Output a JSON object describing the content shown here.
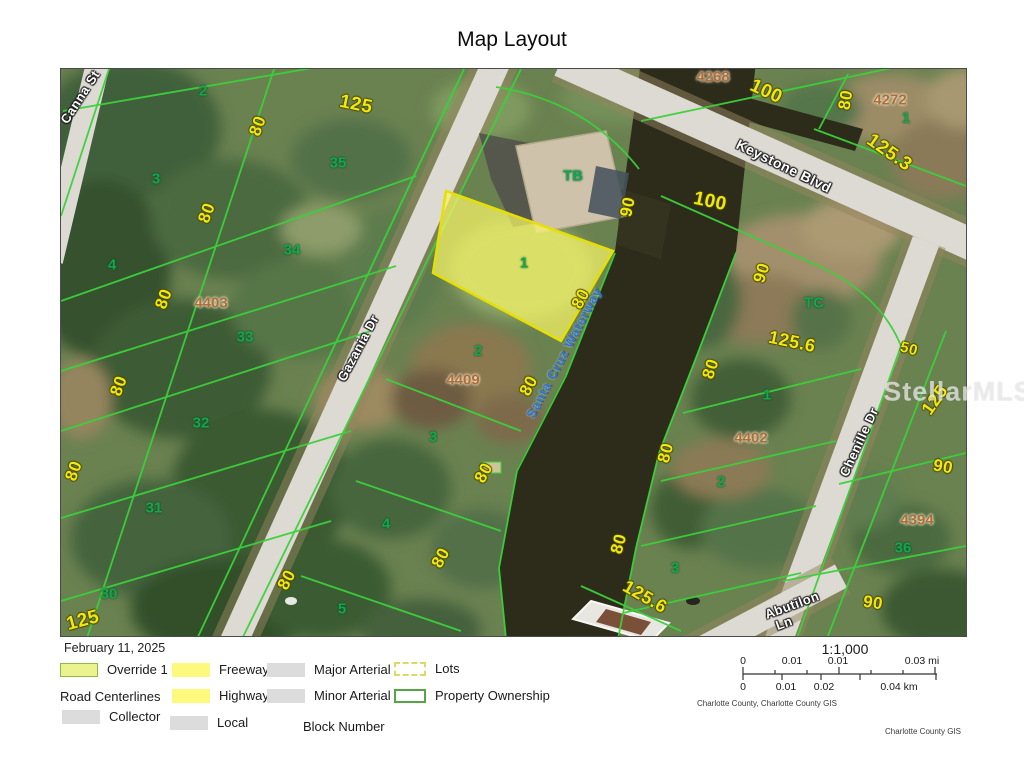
{
  "title": "Map Layout",
  "date": "February 11, 2025",
  "watermark": "StellarMLS",
  "map": {
    "street_labels": [
      {
        "text": "Canna St",
        "x": 19,
        "y": 28,
        "r": -57
      },
      {
        "text": "Gazania Dr",
        "x": 297,
        "y": 279,
        "r": -62
      },
      {
        "text": "Keystone Blvd",
        "x": 723,
        "y": 97,
        "r": 26,
        "fs": 14
      },
      {
        "text": "Chenille Dr",
        "x": 798,
        "y": 373,
        "r": -65
      },
      {
        "text": "Abutilon",
        "x": 731,
        "y": 536,
        "r": -20
      },
      {
        "text": "Ln",
        "x": 723,
        "y": 554,
        "r": -20
      }
    ],
    "water_labels": [
      {
        "text": "Santa Cruz Waterway",
        "x": 503,
        "y": 284,
        "r": -62
      }
    ],
    "lot_numbers": [
      {
        "text": "2",
        "x": 142,
        "y": 22
      },
      {
        "text": "3",
        "x": 95,
        "y": 110
      },
      {
        "text": "4",
        "x": 51,
        "y": 196
      },
      {
        "text": "35",
        "x": 277,
        "y": 94
      },
      {
        "text": "34",
        "x": 231,
        "y": 181
      },
      {
        "text": "33",
        "x": 184,
        "y": 268
      },
      {
        "text": "32",
        "x": 140,
        "y": 354
      },
      {
        "text": "31",
        "x": 93,
        "y": 439
      },
      {
        "text": "30",
        "x": 48,
        "y": 525
      },
      {
        "text": "TB",
        "x": 512,
        "y": 107
      },
      {
        "text": "1",
        "x": 463,
        "y": 194
      },
      {
        "text": "2",
        "x": 417,
        "y": 282
      },
      {
        "text": "3",
        "x": 372,
        "y": 368
      },
      {
        "text": "4",
        "x": 325,
        "y": 455
      },
      {
        "text": "5",
        "x": 281,
        "y": 540
      },
      {
        "text": "1",
        "x": 845,
        "y": 49
      },
      {
        "text": "TC",
        "x": 753,
        "y": 234
      },
      {
        "text": "1",
        "x": 706,
        "y": 326
      },
      {
        "text": "2",
        "x": 660,
        "y": 413
      },
      {
        "text": "3",
        "x": 614,
        "y": 499
      },
      {
        "text": "36",
        "x": 842,
        "y": 479
      }
    ],
    "block_numbers": [
      {
        "text": "4403",
        "x": 150,
        "y": 234
      },
      {
        "text": "4409",
        "x": 402,
        "y": 311
      },
      {
        "text": "4268",
        "x": 652,
        "y": 8
      },
      {
        "text": "4272",
        "x": 829,
        "y": 31
      },
      {
        "text": "4402",
        "x": 690,
        "y": 369
      },
      {
        "text": "4394",
        "x": 856,
        "y": 451
      }
    ],
    "dimension_labels": [
      {
        "text": "125",
        "x": 295,
        "y": 36,
        "r": 12,
        "fs": 19
      },
      {
        "text": "80",
        "x": 197,
        "y": 57,
        "r": -70
      },
      {
        "text": "80",
        "x": 146,
        "y": 144,
        "r": -70
      },
      {
        "text": "80",
        "x": 103,
        "y": 230,
        "r": -70
      },
      {
        "text": "80",
        "x": 58,
        "y": 317,
        "r": -70
      },
      {
        "text": "80",
        "x": 13,
        "y": 402,
        "r": -70
      },
      {
        "text": "125",
        "x": 22,
        "y": 552,
        "r": -15,
        "fs": 19
      },
      {
        "text": "100",
        "x": 705,
        "y": 23,
        "r": 25,
        "fs": 19
      },
      {
        "text": "80",
        "x": 785,
        "y": 31,
        "r": -80
      },
      {
        "text": "125.3",
        "x": 828,
        "y": 84,
        "r": 35,
        "fs": 19
      },
      {
        "text": "100",
        "x": 649,
        "y": 133,
        "r": 12,
        "fs": 19
      },
      {
        "text": "90",
        "x": 567,
        "y": 138,
        "r": -78
      },
      {
        "text": "80",
        "x": 520,
        "y": 230,
        "r": -62
      },
      {
        "text": "80",
        "x": 468,
        "y": 317,
        "r": -62
      },
      {
        "text": "80",
        "x": 423,
        "y": 404,
        "r": -62
      },
      {
        "text": "80",
        "x": 380,
        "y": 489,
        "r": -62
      },
      {
        "text": "80",
        "x": 226,
        "y": 511,
        "r": -62
      },
      {
        "text": "90",
        "x": 701,
        "y": 204,
        "r": -72
      },
      {
        "text": "125.6",
        "x": 731,
        "y": 273,
        "r": 12,
        "fs": 18
      },
      {
        "text": "80",
        "x": 650,
        "y": 300,
        "r": -72
      },
      {
        "text": "50",
        "x": 848,
        "y": 280,
        "r": 15,
        "fs": 15
      },
      {
        "text": "80",
        "x": 605,
        "y": 384,
        "r": -75
      },
      {
        "text": "80",
        "x": 558,
        "y": 475,
        "r": -75
      },
      {
        "text": "125.6",
        "x": 584,
        "y": 528,
        "r": 30,
        "fs": 18
      },
      {
        "text": "90",
        "x": 882,
        "y": 398,
        "r": 10
      },
      {
        "text": "125",
        "x": 874,
        "y": 331,
        "r": -55,
        "fs": 18
      },
      {
        "text": "90",
        "x": 812,
        "y": 534,
        "r": 8
      }
    ]
  },
  "legend": {
    "override": "Override 1",
    "road_centerlines": "Road Centerlines",
    "collector": "Collector",
    "freeway": "Freeway",
    "highway": "Highway",
    "local": "Local",
    "major_arterial": "Major Arterial",
    "minor_arterial": "Minor Arterial",
    "block_number": "Block Number",
    "lots": "Lots",
    "property_ownership": "Property Ownership"
  },
  "scale": {
    "ratio": "1:1,000",
    "mi_ticks": [
      "0",
      "0.01",
      "0.01",
      "0.03 mi"
    ],
    "km_ticks": [
      "0",
      "0.01",
      "0.02",
      "0.04 km"
    ],
    "attribution": "Charlotte County, Charlotte County GIS",
    "credit": "Charlotte County GIS"
  },
  "colors": {
    "parcel_line": "#3bd13b",
    "highlight_lot_fill": "#f7f566",
    "highlight_lot_stroke": "#e6df00",
    "dimension_text": "#f2e70e",
    "lot_number_text": "#10a94e",
    "block_number_text": "#b06d36",
    "water": "#2d2c1b",
    "road": "#dcdad2",
    "override_swatch": "#ecf28e",
    "freeway_swatch": "#fcf97c",
    "road_swatch": "#dcdcdc"
  }
}
